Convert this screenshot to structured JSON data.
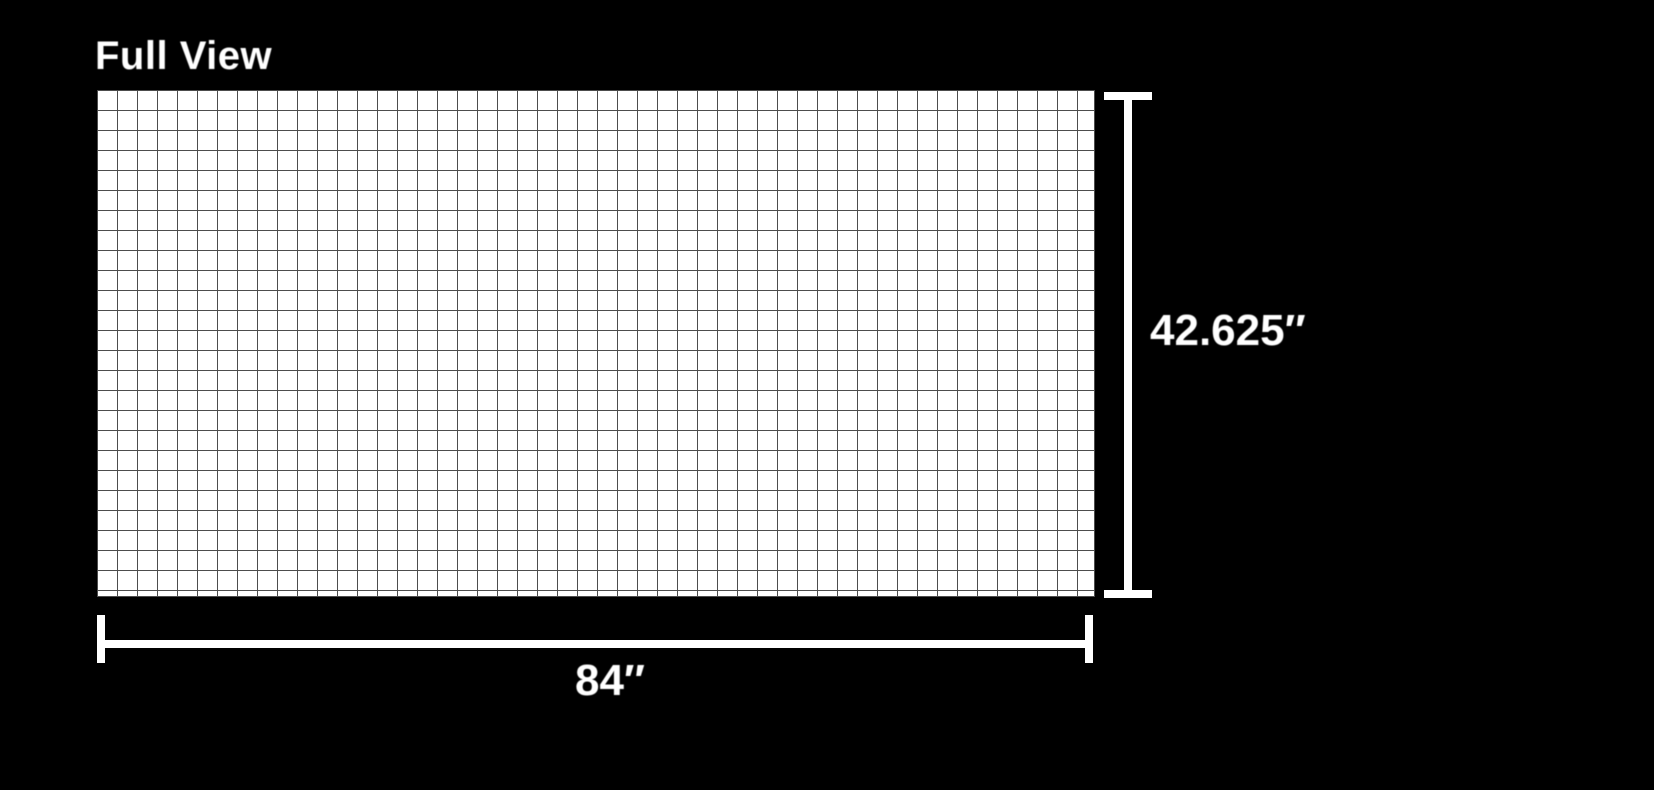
{
  "page": {
    "background_color": "#000000",
    "title": "Full View"
  },
  "diagram": {
    "panel": {
      "fill_color": "#ffffff",
      "grid_line_color": "#4d4d4d",
      "grid_columns": 50,
      "grid_rows": 25
    },
    "dimensions": {
      "color": "#ffffff",
      "height_label": "42.625″",
      "width_label": "84″"
    }
  }
}
